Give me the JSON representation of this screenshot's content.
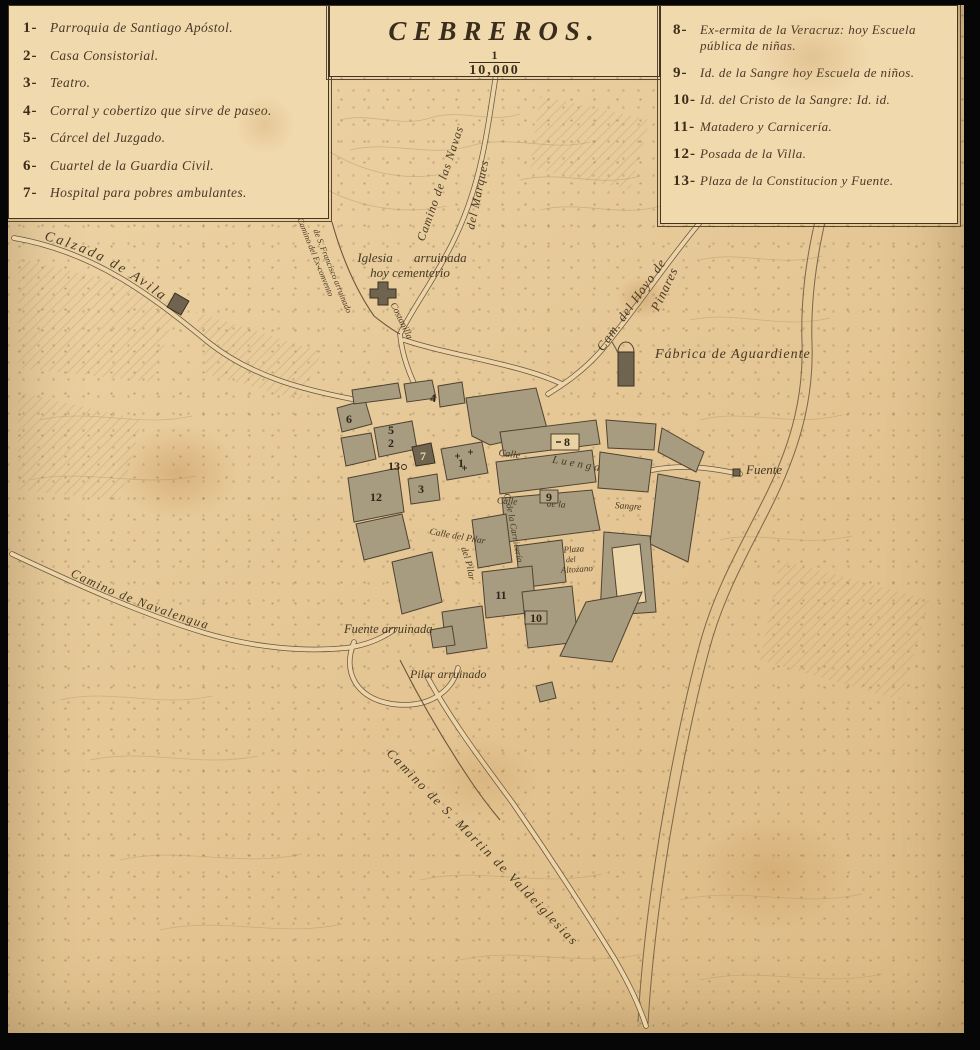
{
  "title_box": {
    "title": "CEBREROS.",
    "scale_numerator": "1",
    "scale_denominator": "10,000"
  },
  "legend_left": {
    "items": [
      {
        "num": "1-",
        "text": "Parroquia de Santiago Apóstol."
      },
      {
        "num": "2-",
        "text": "Casa Consistorial."
      },
      {
        "num": "3-",
        "text": "Teatro."
      },
      {
        "num": "4-",
        "text": "Corral y cobertizo que sirve de paseo."
      },
      {
        "num": "5-",
        "text": "Cárcel del Juzgado."
      },
      {
        "num": "6-",
        "text": "Cuartel de la Guardia Civil."
      },
      {
        "num": "7-",
        "text": "Hospital para pobres ambulantes."
      }
    ]
  },
  "legend_right": {
    "items": [
      {
        "num": "8-",
        "text": "Ex-ermita de la Veracruz: hoy Escuela pública de niñas."
      },
      {
        "num": "9-",
        "text": "Id. de la Sangre hoy Escuela de niños."
      },
      {
        "num": "10-",
        "text": "Id. del Cristo de la Sangre: Id. id."
      },
      {
        "num": "11-",
        "text": "Matadero y Carnicería."
      },
      {
        "num": "12-",
        "text": "Posada de la Villa."
      },
      {
        "num": "13-",
        "text": "Plaza de la Constitucion y Fuente."
      }
    ]
  },
  "map": {
    "labels": {
      "calzada_avila": "Calzada de Avila",
      "camino_navas": "Camino de las Navas",
      "del_marques": "del Marques",
      "exconvento_1": "Camino del Ex-convento",
      "exconvento_2": "de S. Francisco arruinado",
      "iglesia_arruinada": "Iglesia arruinada",
      "hoy_cementerio": "hoy cementerio",
      "costanilla": "Costanilla",
      "cam_hoyo": "Cam. del Hoyo de",
      "pinares": "Pinares",
      "fabrica_aguardiente": "Fábrica de Aguardiente",
      "fuente": "Fuente",
      "calle_luenga_1": "Calle",
      "calle_luenga_2": "Luenga",
      "calle_sangre_1": "Calle",
      "calle_sangre_2": "de la",
      "calle_sangre_3": "Sangre",
      "calle_carniceria": "C. de la Carnicería",
      "calle_pilar_1": "Calle del Pilar",
      "calle_pilar_2": "del Pilar",
      "plaza_altozano_1": "Plaza",
      "plaza_altozano_2": "del",
      "plaza_altozano_3": "Altozano",
      "fuente_arruinada": "Fuente arruinada",
      "pilar_arruinado": "Pilar arruinado",
      "camino_navalengua": "Camino de Navalengua",
      "camino_smartin": "Camino de S. Martin de Valdeiglesias"
    },
    "markers": [
      {
        "n": "1"
      },
      {
        "n": "2"
      },
      {
        "n": "3"
      },
      {
        "n": "4"
      },
      {
        "n": "5"
      },
      {
        "n": "6"
      },
      {
        "n": "7"
      },
      {
        "n": "8"
      },
      {
        "n": "9"
      },
      {
        "n": "10"
      },
      {
        "n": "11"
      },
      {
        "n": "12"
      },
      {
        "n": "13"
      }
    ],
    "colors": {
      "paper": "#e6c897",
      "ink": "#43351f",
      "block_fill": "#a79c80",
      "frame": "#060606"
    }
  }
}
